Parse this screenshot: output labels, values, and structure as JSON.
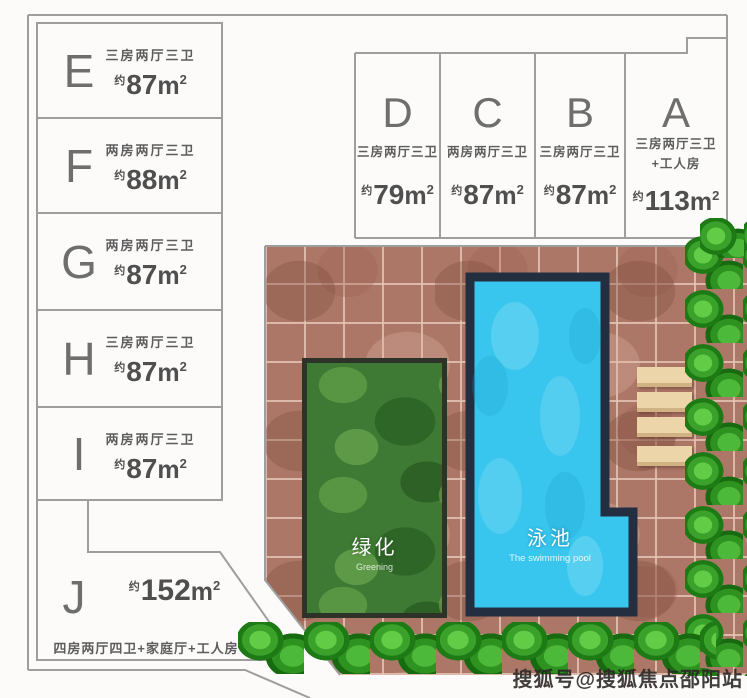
{
  "strings": {
    "approx": "约",
    "unit": "m",
    "sup": "2"
  },
  "units_left": [
    {
      "id": "E",
      "type": "三房两厅三卫",
      "area": "87"
    },
    {
      "id": "F",
      "type": "两房两厅三卫",
      "area": "88"
    },
    {
      "id": "G",
      "type": "两房两厅三卫",
      "area": "87"
    },
    {
      "id": "H",
      "type": "三房两厅三卫",
      "area": "87"
    },
    {
      "id": "I",
      "type": "两房两厅三卫",
      "area": "87"
    }
  ],
  "units_top": [
    {
      "id": "D",
      "type": "三房两厅三卫",
      "area": "79"
    },
    {
      "id": "C",
      "type": "两房两厅三卫",
      "area": "87"
    },
    {
      "id": "B",
      "type": "三房两厅三卫",
      "area": "87"
    },
    {
      "id": "A",
      "type": "三房两厅三卫",
      "type2": "+工人房",
      "area": "113"
    }
  ],
  "unit_j": {
    "id": "J",
    "area": "152",
    "type": "四房两厅四卫+家庭厅+工人房"
  },
  "courtyard": {
    "greening_label": "绿化",
    "greening_sub": "Greening",
    "pool_label": "泳池",
    "pool_sub": "The swimming pool"
  },
  "watermark": "搜狐号@搜狐焦点邵阳站",
  "colors": {
    "tile": "#ad7767",
    "tile_grout": "#e4c4b4",
    "pool_water": "#38c6ee",
    "pool_border": "#232e41",
    "greening": "#3e7a33",
    "hedge": "#3da52c",
    "bench": "#ecd5a9",
    "line": "#9e9e9e",
    "text": "#5d5d5d",
    "watermark": "#2b2826"
  }
}
